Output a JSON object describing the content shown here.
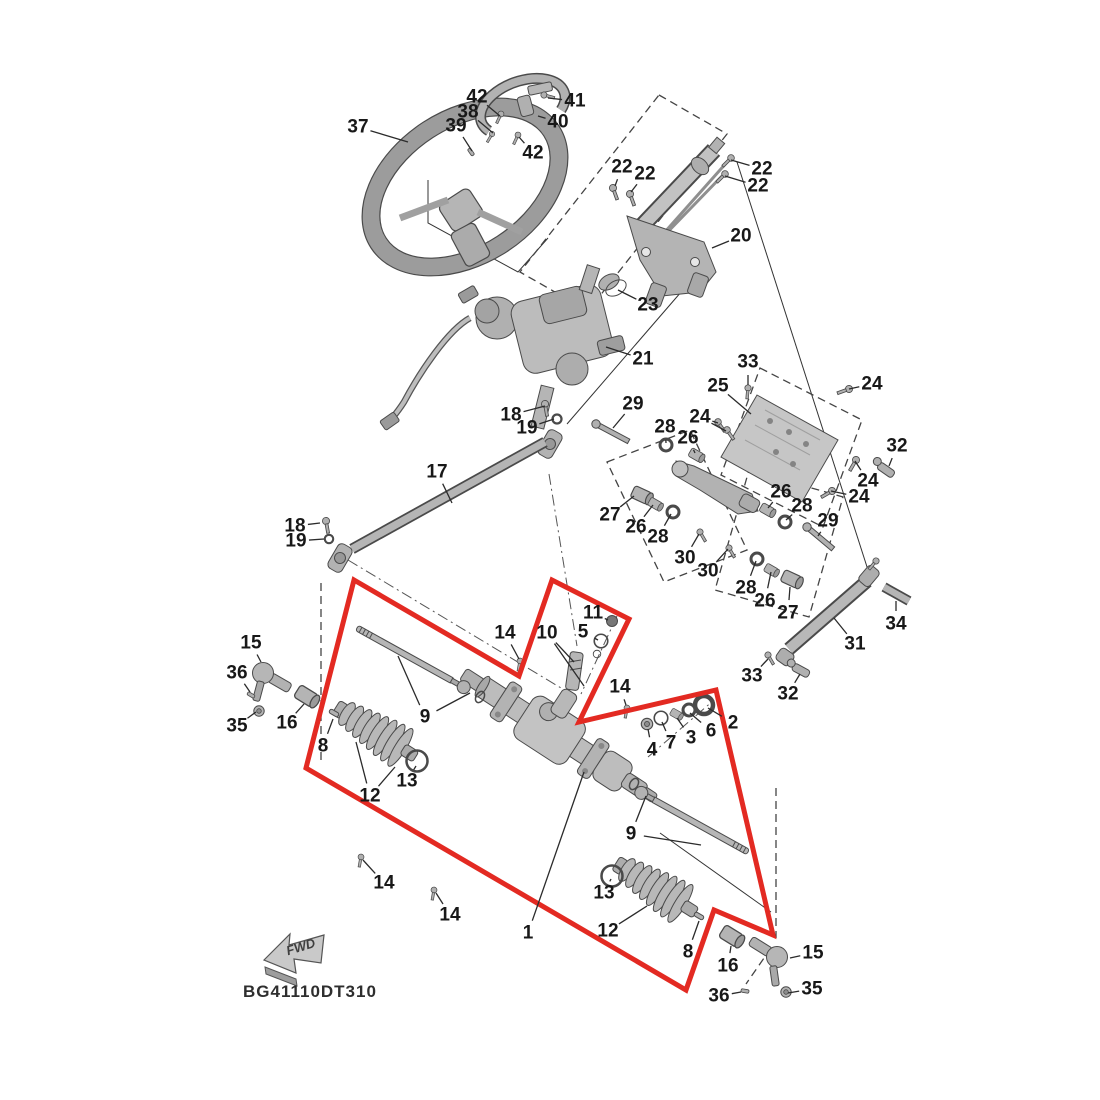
{
  "diagram": {
    "title_code": "BG41110DT310",
    "fwd_label": "FWD",
    "highlight_color": "#e32a22",
    "highlight_points": "354,580 519,676 552,580 629,619 579,722 716,690 773,935 714,910 686,990 306,768",
    "labels": [
      {
        "t": "37",
        "x": 358,
        "y": 127,
        "leads": [
          [
            408,
            142
          ]
        ]
      },
      {
        "t": "42",
        "x": 477,
        "y": 97,
        "leads": [
          [
            500,
            116
          ]
        ]
      },
      {
        "t": "38",
        "x": 468,
        "y": 112,
        "leads": [
          [
            493,
            133
          ]
        ]
      },
      {
        "t": "39",
        "x": 456,
        "y": 126,
        "leads": [
          [
            472,
            151
          ]
        ]
      },
      {
        "t": "41",
        "x": 575,
        "y": 101,
        "leads": [
          [
            548,
            98
          ]
        ]
      },
      {
        "t": "40",
        "x": 558,
        "y": 122,
        "leads": [
          [
            538,
            116
          ]
        ]
      },
      {
        "t": "42",
        "x": 533,
        "y": 153,
        "leads": [
          [
            519,
            137
          ]
        ]
      },
      {
        "t": "22",
        "x": 622,
        "y": 167,
        "leads": [
          [
            615,
            186
          ]
        ]
      },
      {
        "t": "22",
        "x": 645,
        "y": 174,
        "leads": [
          [
            631,
            192
          ]
        ]
      },
      {
        "t": "22",
        "x": 762,
        "y": 169,
        "leads": [
          [
            731,
            160
          ]
        ]
      },
      {
        "t": "22",
        "x": 758,
        "y": 186,
        "leads": [
          [
            725,
            176
          ]
        ]
      },
      {
        "t": "20",
        "x": 741,
        "y": 236,
        "leads": [
          [
            712,
            248
          ]
        ]
      },
      {
        "t": "23",
        "x": 648,
        "y": 305,
        "leads": [
          [
            618,
            290
          ]
        ]
      },
      {
        "t": "21",
        "x": 643,
        "y": 359,
        "leads": [
          [
            606,
            347
          ]
        ]
      },
      {
        "t": "18",
        "x": 511,
        "y": 415,
        "leads": [
          [
            545,
            406
          ]
        ]
      },
      {
        "t": "19",
        "x": 527,
        "y": 428,
        "leads": [
          [
            554,
            419
          ]
        ]
      },
      {
        "t": "29",
        "x": 633,
        "y": 404,
        "leads": [
          [
            613,
            428
          ]
        ]
      },
      {
        "t": "28",
        "x": 665,
        "y": 427,
        "leads": [
          [
            666,
            443
          ]
        ]
      },
      {
        "t": "26",
        "x": 688,
        "y": 438,
        "leads": [
          [
            695,
            453
          ]
        ]
      },
      {
        "t": "24",
        "x": 700,
        "y": 417,
        "leads": [
          [
            718,
            423
          ],
          [
            726,
            431
          ]
        ]
      },
      {
        "t": "33",
        "x": 748,
        "y": 362,
        "leads": [
          [
            748,
            385
          ]
        ]
      },
      {
        "t": "25",
        "x": 718,
        "y": 386,
        "leads": [
          [
            751,
            414
          ]
        ]
      },
      {
        "t": "24",
        "x": 872,
        "y": 384,
        "leads": [
          [
            849,
            389
          ]
        ]
      },
      {
        "t": "32",
        "x": 897,
        "y": 446,
        "leads": [
          [
            889,
            466
          ]
        ]
      },
      {
        "t": "24",
        "x": 868,
        "y": 481,
        "leads": [
          [
            855,
            461
          ]
        ]
      },
      {
        "t": "24",
        "x": 859,
        "y": 497,
        "leads": [
          [
            831,
            491
          ]
        ]
      },
      {
        "t": "26",
        "x": 781,
        "y": 492,
        "leads": [
          [
            768,
            508
          ]
        ]
      },
      {
        "t": "28",
        "x": 802,
        "y": 506,
        "leads": [
          [
            786,
            520
          ]
        ]
      },
      {
        "t": "29",
        "x": 828,
        "y": 521,
        "leads": [
          [
            818,
            536
          ]
        ]
      },
      {
        "t": "17",
        "x": 437,
        "y": 472,
        "leads": [
          [
            452,
            503
          ]
        ]
      },
      {
        "t": "18",
        "x": 295,
        "y": 526,
        "leads": [
          [
            320,
            523
          ]
        ]
      },
      {
        "t": "19",
        "x": 296,
        "y": 541,
        "leads": [
          [
            324,
            539
          ]
        ]
      },
      {
        "t": "27",
        "x": 610,
        "y": 515,
        "leads": [
          [
            634,
            496
          ]
        ]
      },
      {
        "t": "26",
        "x": 636,
        "y": 527,
        "leads": [
          [
            653,
            505
          ]
        ]
      },
      {
        "t": "28",
        "x": 658,
        "y": 537,
        "leads": [
          [
            671,
            514
          ]
        ]
      },
      {
        "t": "30",
        "x": 685,
        "y": 558,
        "leads": [
          [
            699,
            534
          ]
        ]
      },
      {
        "t": "30",
        "x": 708,
        "y": 571,
        "leads": [
          [
            728,
            549
          ]
        ]
      },
      {
        "t": "28",
        "x": 746,
        "y": 588,
        "leads": [
          [
            756,
            561
          ]
        ]
      },
      {
        "t": "26",
        "x": 765,
        "y": 601,
        "leads": [
          [
            771,
            572
          ]
        ]
      },
      {
        "t": "27",
        "x": 788,
        "y": 613,
        "leads": [
          [
            790,
            587
          ]
        ]
      },
      {
        "t": "34",
        "x": 896,
        "y": 624,
        "leads": [
          [
            896,
            601
          ]
        ]
      },
      {
        "t": "31",
        "x": 855,
        "y": 644,
        "leads": [
          [
            834,
            618
          ]
        ]
      },
      {
        "t": "33",
        "x": 752,
        "y": 676,
        "leads": [
          [
            768,
            659
          ]
        ]
      },
      {
        "t": "32",
        "x": 788,
        "y": 694,
        "leads": [
          [
            800,
            674
          ]
        ]
      },
      {
        "t": "15",
        "x": 251,
        "y": 643,
        "leads": [
          [
            261,
            662
          ]
        ]
      },
      {
        "t": "36",
        "x": 237,
        "y": 673,
        "leads": [
          [
            250,
            692
          ]
        ]
      },
      {
        "t": "35",
        "x": 237,
        "y": 726,
        "leads": [
          [
            256,
            712
          ]
        ]
      },
      {
        "t": "16",
        "x": 287,
        "y": 723,
        "leads": [
          [
            304,
            704
          ]
        ]
      },
      {
        "t": "8",
        "x": 323,
        "y": 746,
        "leads": [
          [
            333,
            719
          ]
        ]
      },
      {
        "t": "9",
        "x": 425,
        "y": 717,
        "leads": [
          [
            398,
            656
          ],
          [
            470,
            693
          ]
        ]
      },
      {
        "t": "13",
        "x": 407,
        "y": 781,
        "leads": [
          [
            416,
            766
          ]
        ]
      },
      {
        "t": "12",
        "x": 370,
        "y": 796,
        "leads": [
          [
            356,
            742
          ],
          [
            395,
            767
          ]
        ]
      },
      {
        "t": "14",
        "x": 505,
        "y": 633,
        "leads": [
          [
            519,
            659
          ]
        ]
      },
      {
        "t": "11",
        "x": 593,
        "y": 613,
        "leads": [
          [
            608,
            620
          ]
        ]
      },
      {
        "t": "10",
        "x": 547,
        "y": 633,
        "leads": [
          [
            574,
            662
          ],
          [
            584,
            686
          ]
        ]
      },
      {
        "t": "5",
        "x": 583,
        "y": 632,
        "leads": [
          [
            598,
            640
          ]
        ]
      },
      {
        "t": "14",
        "x": 620,
        "y": 687,
        "leads": [
          [
            626,
            705
          ]
        ]
      },
      {
        "t": "2",
        "x": 733,
        "y": 723,
        "leads": [
          [
            708,
            708
          ]
        ]
      },
      {
        "t": "6",
        "x": 711,
        "y": 731,
        "leads": [
          [
            690,
            713
          ]
        ]
      },
      {
        "t": "3",
        "x": 691,
        "y": 738,
        "leads": [
          [
            677,
            718
          ]
        ]
      },
      {
        "t": "7",
        "x": 671,
        "y": 743,
        "leads": [
          [
            662,
            722
          ]
        ]
      },
      {
        "t": "4",
        "x": 652,
        "y": 750,
        "leads": [
          [
            648,
            729
          ]
        ]
      },
      {
        "t": "9",
        "x": 631,
        "y": 834,
        "leads": [
          [
            646,
            796
          ],
          [
            701,
            845
          ]
        ]
      },
      {
        "t": "13",
        "x": 604,
        "y": 893,
        "leads": [
          [
            611,
            879
          ]
        ]
      },
      {
        "t": "12",
        "x": 608,
        "y": 931,
        "leads": [
          [
            647,
            906
          ]
        ]
      },
      {
        "t": "8",
        "x": 688,
        "y": 952,
        "leads": [
          [
            699,
            921
          ]
        ]
      },
      {
        "t": "16",
        "x": 728,
        "y": 966,
        "leads": [
          [
            731,
            946
          ]
        ]
      },
      {
        "t": "15",
        "x": 813,
        "y": 953,
        "leads": [
          [
            790,
            958
          ]
        ]
      },
      {
        "t": "36",
        "x": 719,
        "y": 996,
        "leads": [
          [
            741,
            992
          ]
        ]
      },
      {
        "t": "35",
        "x": 812,
        "y": 989,
        "leads": [
          [
            788,
            993
          ]
        ]
      },
      {
        "t": "14",
        "x": 384,
        "y": 883,
        "leads": [
          [
            363,
            860
          ]
        ]
      },
      {
        "t": "14",
        "x": 450,
        "y": 915,
        "leads": [
          [
            436,
            893
          ]
        ]
      },
      {
        "t": "1",
        "x": 528,
        "y": 933,
        "leads": [
          [
            584,
            772
          ]
        ]
      }
    ]
  }
}
